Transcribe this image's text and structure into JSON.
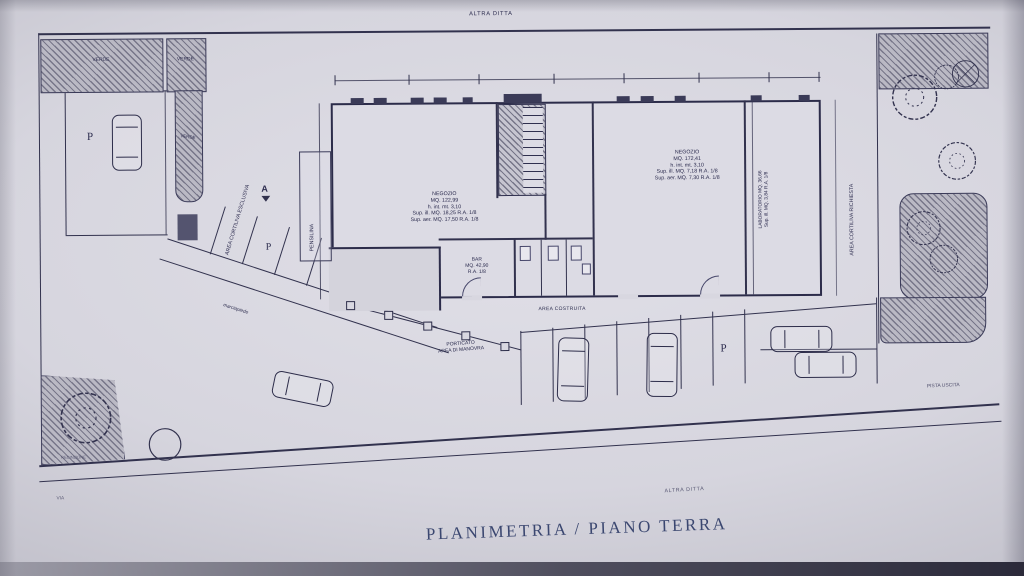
{
  "title": "PLANIMETRIA / PIANO TERRA",
  "site": {
    "altra_ditta_top": "ALTRA DITTA",
    "altra_ditta_bottom": "ALTRA DITTA",
    "via": "VIA",
    "pista": "PISTA USCITA",
    "verde": "VERDE",
    "parking": "P",
    "section_a": "A",
    "cortiliva_esclusiva": "AREA CORTILIVA ESCLUSIVA",
    "cortiliva_richiesta": "AREA CORTILIVA RICHIESTA",
    "area_costruita": "AREA COSTRUITA",
    "pensilina": "PENSILINA",
    "porticato": "PORTICATO",
    "area_di_manovra": "AREA DI MANOVRA",
    "marciapiede": "marciapiede",
    "recinzione": "RECINZIONE"
  },
  "rooms": {
    "negozio_left": {
      "name": "NEGOZIO",
      "area": "MQ. 122,99",
      "height": "h. int. mt. 3,10",
      "sup_ill": "Sup. ill. MQ. 18,25 R.A. 1/8",
      "sup_aer": "Sup. aer. MQ. 17,50 R.A. 1/8"
    },
    "negozio_right": {
      "name": "NEGOZIO",
      "area": "MQ. 172,41",
      "height": "h. int. mt. 3,10",
      "sup_ill": "Sup. ill. MQ. 7,18 R.A. 1/8",
      "sup_aer": "Sup. aer. MQ. 7,30 R.A. 1/8"
    },
    "bar": {
      "name": "BAR",
      "area": "MQ. 42,90",
      "ratio": "R.A. 1/8"
    },
    "laboratorio": {
      "line1": "LABORATORIO MQ. 36,66",
      "line2": "Sup. ill. MQ. 3,84 R.A. 1/8"
    }
  },
  "colors": {
    "ink": "#32324e",
    "paper": "#d7d6df",
    "title": "#3b4770"
  }
}
